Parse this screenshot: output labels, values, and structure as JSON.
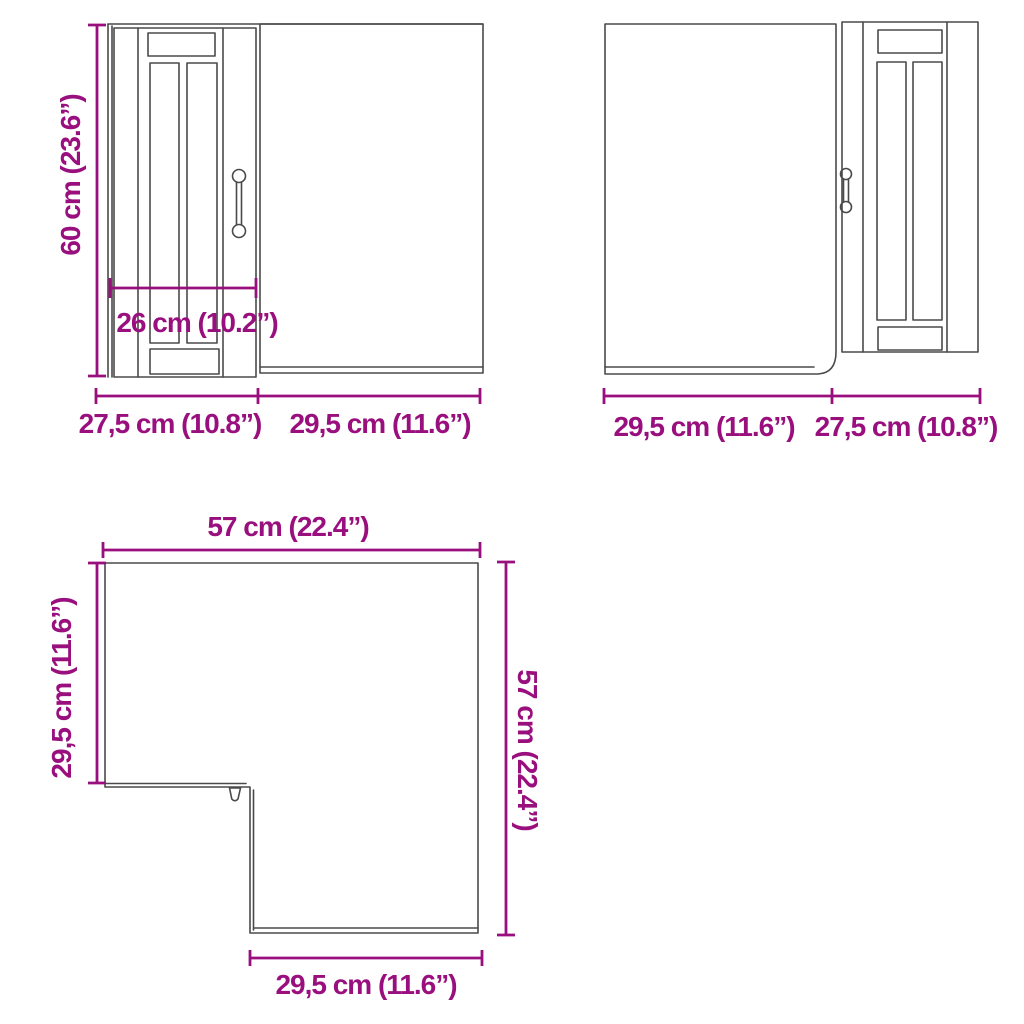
{
  "title": "Corner wall cabinet dimension diagram",
  "colors": {
    "accent": "#9a0f7e",
    "line": "#4a4a4a",
    "background": "#ffffff"
  },
  "views": {
    "front_left": {
      "description": "front view, framed glass door on left, side panel on right",
      "labels": {
        "height": "60 cm (23.6”)",
        "door_width": "26 cm (10.2”)",
        "bottom_left": "27,5 cm (10.8”)",
        "bottom_right": "29,5 cm (11.6”)"
      }
    },
    "front_right": {
      "description": "mirrored front view, side panel on left, framed glass door on right",
      "labels": {
        "bottom_left": "29,5 cm (11.6”)",
        "bottom_right": "27,5 cm (10.8”)"
      }
    },
    "plan": {
      "description": "top view of L-shaped corner cabinet",
      "labels": {
        "top": "57 cm (22.4”)",
        "left": "29,5 cm (11.6”)",
        "right": "57 cm (22.4”)",
        "bottom": "29,5 cm (11.6”)"
      }
    }
  }
}
